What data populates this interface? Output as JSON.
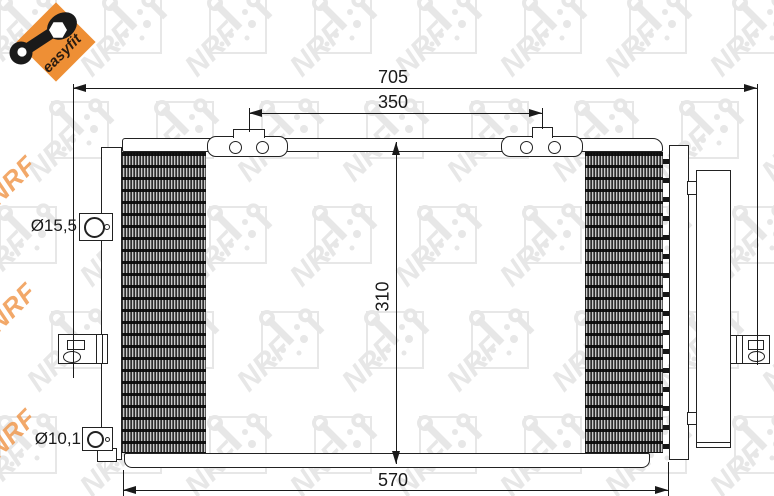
{
  "badge": {
    "label": "easyfit",
    "color": "#EE8F35",
    "icon": "wrench-icon"
  },
  "watermark": {
    "brand": "NRF",
    "gray": "#e7e7e7",
    "orange": "#F09A50"
  },
  "drawing": {
    "dim_overall_width": "705",
    "dim_bracket_span": "350",
    "dim_core_height": "310",
    "dim_core_width": "570",
    "label_top_fitting_diameter": "Ø15,5",
    "label_bottom_fitting_diameter": "Ø10,1"
  }
}
